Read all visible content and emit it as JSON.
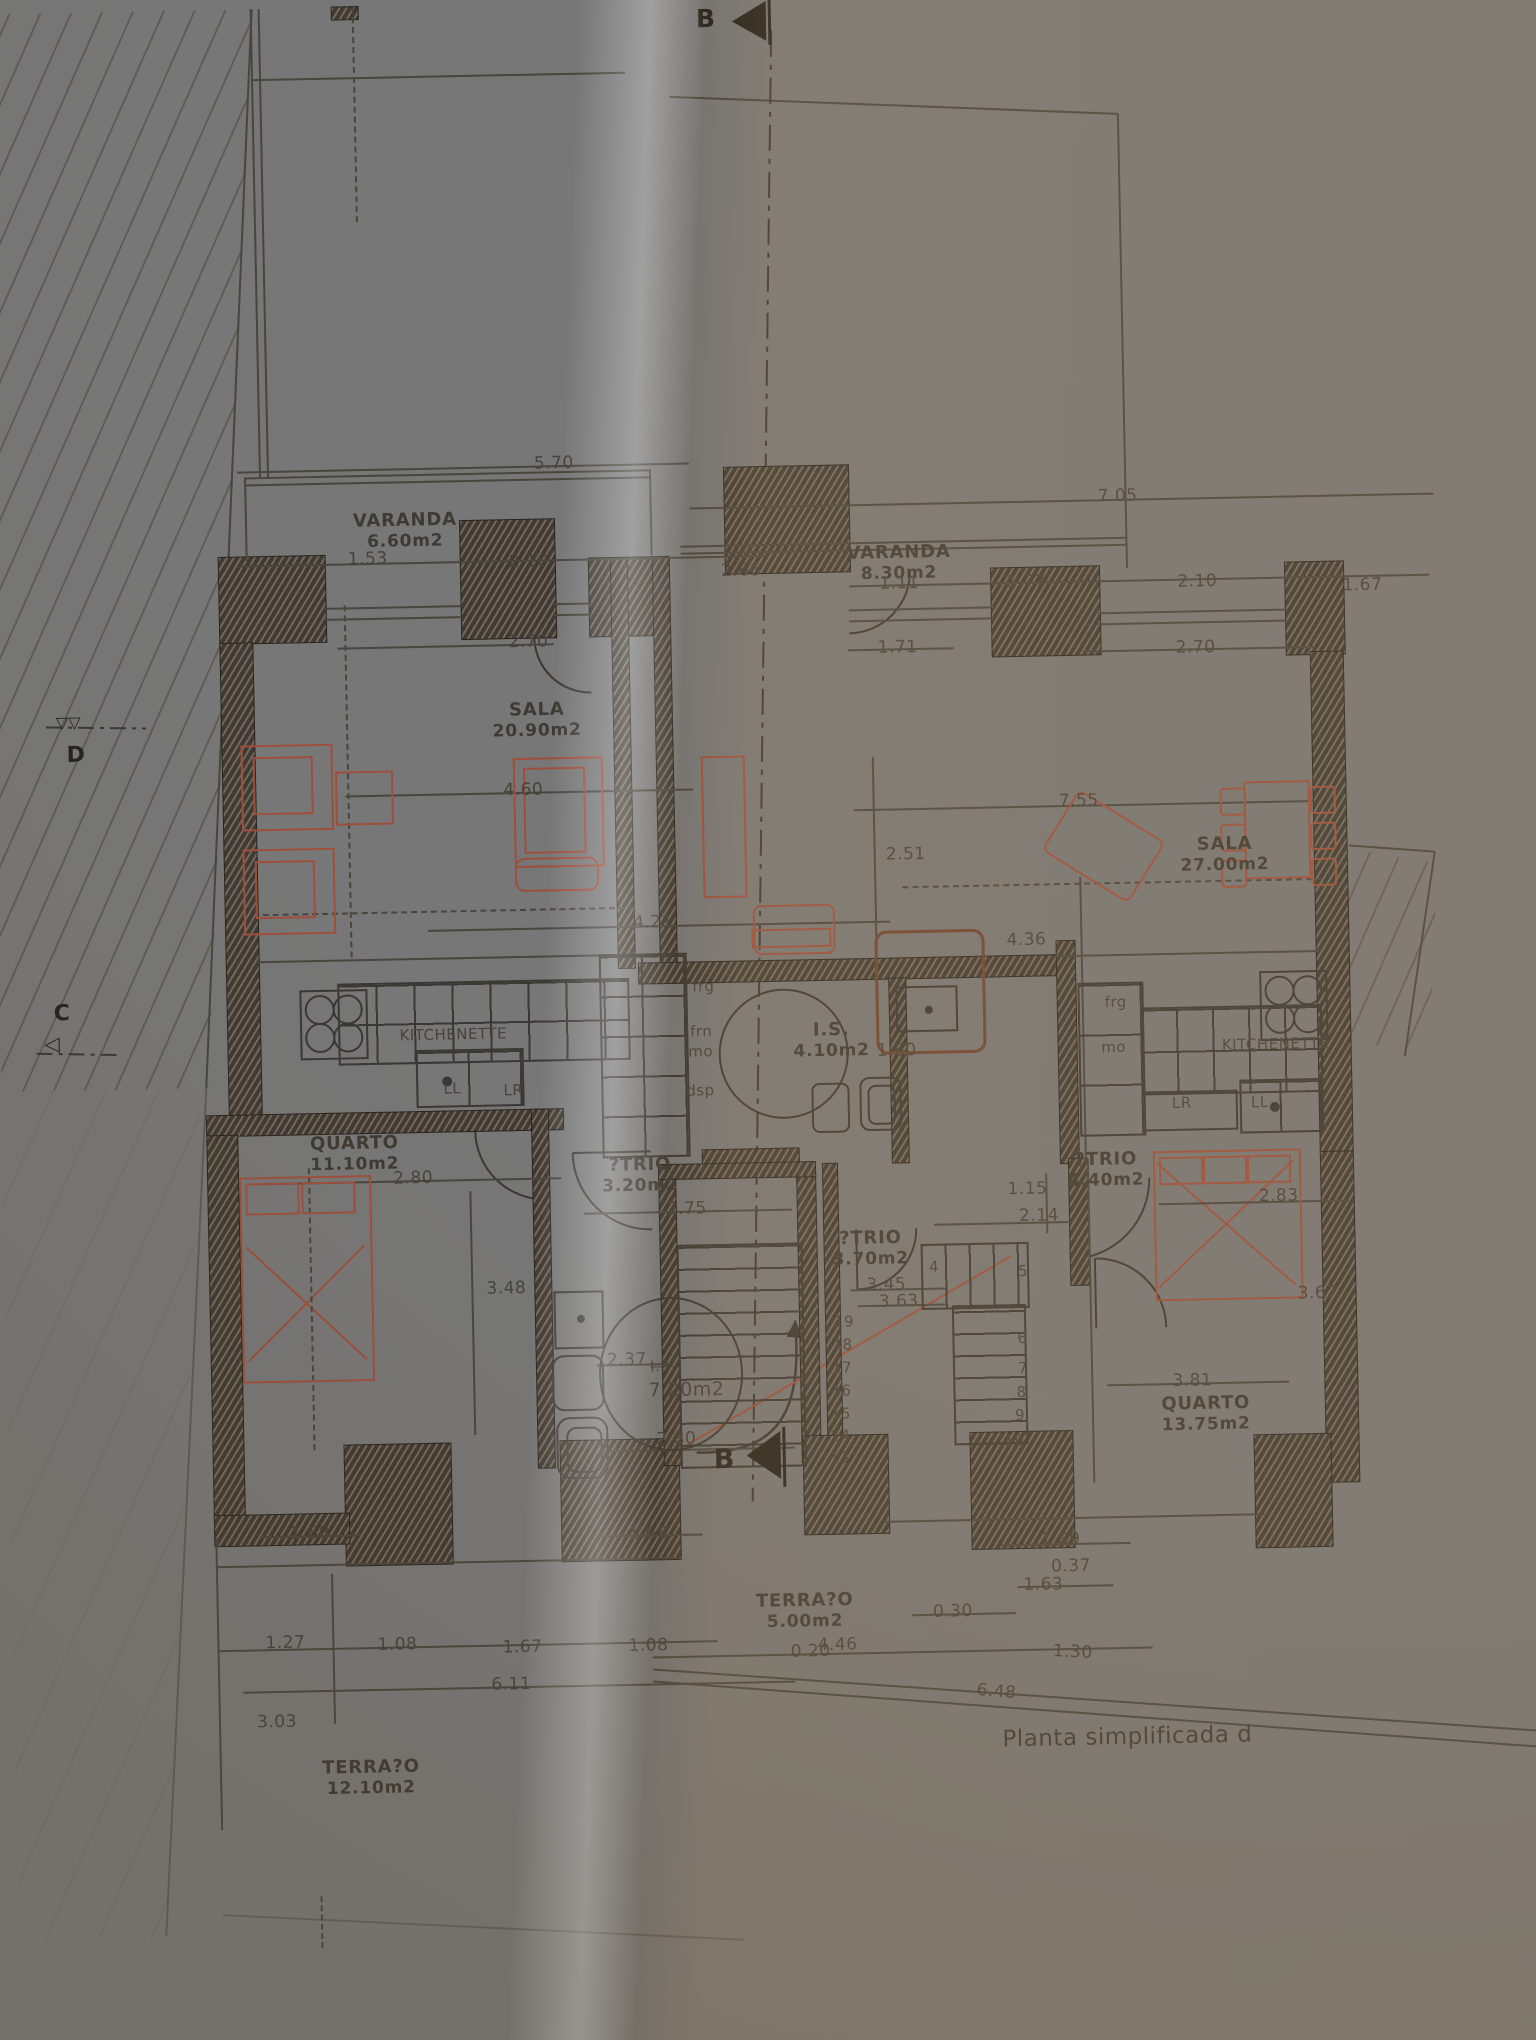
{
  "caption": "Planta simplificada d",
  "markers": {
    "section_top": "B",
    "section_bottom": "B",
    "section_d": "D",
    "section_c": "C"
  },
  "colors": {
    "ink": "#47423a",
    "wall": "#403a33",
    "furniture_accent": "#9e4f3c",
    "paper_left": "#e5e3df",
    "paper_right": "#d5c1a2"
  },
  "rooms": [
    {
      "name": "VARANDA",
      "area": "6.60m2",
      "x": 415,
      "y": 514
    },
    {
      "name": "VARANDA",
      "area": "8.30m2",
      "x": 908,
      "y": 556
    },
    {
      "name": "SALA",
      "area": "20.90m2",
      "x": 543,
      "y": 706
    },
    {
      "name": "SALA",
      "area": "27.00m2",
      "x": 1228,
      "y": 854
    },
    {
      "name": "QUARTO",
      "area": "11.10m2",
      "x": 352,
      "y": 1136
    },
    {
      "name": "QUARTO",
      "area": "13.75m2",
      "x": 1198,
      "y": 1413
    },
    {
      "name": "?TRIO",
      "area": "3.20m2",
      "x": 637,
      "y": 1163
    },
    {
      "name": "?TRIO",
      "area": "3.70m2",
      "x": 866,
      "y": 1241
    },
    {
      "name": "?TRIO",
      "area": "4.40m2",
      "x": 1103,
      "y": 1167
    },
    {
      "name": "I.S.",
      "area": "4.10m2",
      "x": 831,
      "y": 1032
    },
    {
      "name": "TERRA?O",
      "area": "5.00m2",
      "x": 793,
      "y": 1602
    },
    {
      "name": "TERRA?O",
      "area": "12.10m2",
      "x": 356,
      "y": 1760
    }
  ],
  "dims": [
    {
      "t": "5.70",
      "x": 565,
      "y": 460
    },
    {
      "t": "1.53",
      "x": 377,
      "y": 552
    },
    {
      "t": "2.10",
      "x": 538,
      "y": 558
    },
    {
      "t": "2.66",
      "x": 750,
      "y": 571
    },
    {
      "t": "2.70",
      "x": 536,
      "y": 638
    },
    {
      "t": "4.60",
      "x": 528,
      "y": 786
    },
    {
      "t": "4.21",
      "x": 655,
      "y": 921
    },
    {
      "t": "7.05",
      "x": 1128,
      "y": 504
    },
    {
      "t": "1.11",
      "x": 908,
      "y": 587
    },
    {
      "t": "1.77",
      "x": 1035,
      "y": 588
    },
    {
      "t": "2.10",
      "x": 1206,
      "y": 591
    },
    {
      "t": "1.67",
      "x": 1371,
      "y": 598
    },
    {
      "t": "1.71",
      "x": 905,
      "y": 651
    },
    {
      "t": "2.70",
      "x": 1203,
      "y": 657
    },
    {
      "t": "7.55",
      "x": 1083,
      "y": 808
    },
    {
      "t": "2.51",
      "x": 909,
      "y": 858
    },
    {
      "t": "4.36",
      "x": 1028,
      "y": 946
    },
    {
      "t": "1.60",
      "x": 896,
      "y": 1054
    },
    {
      "t": "2.80",
      "x": 410,
      "y": 1172
    },
    {
      "t": "2.75",
      "x": 683,
      "y": 1208
    },
    {
      "t": "1.15",
      "x": 1024,
      "y": 1195
    },
    {
      "t": "2.14",
      "x": 1035,
      "y": 1222
    },
    {
      "t": "2.83",
      "x": 1275,
      "y": 1207
    },
    {
      "t": "3.45",
      "x": 881,
      "y": 1288
    },
    {
      "t": "3.63",
      "x": 893,
      "y": 1305
    },
    {
      "t": "3.48",
      "x": 501,
      "y": 1284
    },
    {
      "t": "2.37",
      "x": 620,
      "y": 1358
    },
    {
      "t": "2.80",
      "x": 668,
      "y": 1438
    },
    {
      "t": "3.67",
      "x": 1312,
      "y": 1305
    },
    {
      "t": "3.81",
      "x": 1185,
      "y": 1390
    },
    {
      "t": "1.89",
      "x": 1050,
      "y": 1546
    },
    {
      "t": "1.68",
      "x": 300,
      "y": 1525
    },
    {
      "t": "1.68",
      "x": 638,
      "y": 1532
    },
    {
      "t": "0.30",
      "x": 941,
      "y": 1616
    },
    {
      "t": "0.37",
      "x": 1060,
      "y": 1573
    },
    {
      "t": "1.63",
      "x": 1032,
      "y": 1591
    },
    {
      "t": "4.46",
      "x": 825,
      "y": 1647
    },
    {
      "t": "0.20",
      "x": 798,
      "y": 1653
    },
    {
      "t": "1.30",
      "x": 1060,
      "y": 1659,
      "r": 4
    },
    {
      "t": "6.48",
      "x": 983,
      "y": 1697,
      "r": 6
    },
    {
      "t": "1.27",
      "x": 273,
      "y": 1634
    },
    {
      "t": "1.08",
      "x": 385,
      "y": 1638
    },
    {
      "t": "1.67",
      "x": 510,
      "y": 1643
    },
    {
      "t": "1.08",
      "x": 636,
      "y": 1644
    },
    {
      "t": "6.11",
      "x": 498,
      "y": 1680
    },
    {
      "t": "3.03",
      "x": 263,
      "y": 1713
    }
  ],
  "fixtures": [
    {
      "t": "KITCHENETTE",
      "x": 453,
      "y": 1029
    },
    {
      "t": "frg",
      "x": 704,
      "y": 986
    },
    {
      "t": "frn",
      "x": 701,
      "y": 1031
    },
    {
      "t": "mo",
      "x": 700,
      "y": 1051
    },
    {
      "t": "dsp",
      "x": 699,
      "y": 1090
    },
    {
      "t": "LL",
      "x": 451,
      "y": 1083
    },
    {
      "t": "LR",
      "x": 512,
      "y": 1086
    },
    {
      "t": "frg",
      "x": 1116,
      "y": 1010
    },
    {
      "t": "mo",
      "x": 1113,
      "y": 1055
    },
    {
      "t": "KITCHENETTE",
      "x": 1275,
      "y": 1055
    },
    {
      "t": "LR",
      "x": 1180,
      "y": 1112
    },
    {
      "t": "LL",
      "x": 1258,
      "y": 1113
    },
    {
      "t": "I.S.",
      "x": 656,
      "y": 1365,
      "strike": true
    },
    {
      "t": "7.20m2",
      "x": 679,
      "y": 1389,
      "fs": 19
    }
  ],
  "stairs": [
    {
      "t": "19",
      "x": 838,
      "y": 1324
    },
    {
      "t": "18",
      "x": 836,
      "y": 1347
    },
    {
      "t": "17",
      "x": 835,
      "y": 1370
    },
    {
      "t": "16",
      "x": 834,
      "y": 1393
    },
    {
      "t": "15",
      "x": 833,
      "y": 1416
    },
    {
      "t": "14",
      "x": 832,
      "y": 1438
    },
    {
      "t": "13",
      "x": 831,
      "y": 1460
    },
    {
      "t": "4",
      "x": 929,
      "y": 1271
    },
    {
      "t": "5",
      "x": 1018,
      "y": 1277
    },
    {
      "t": "6",
      "x": 1016,
      "y": 1344
    },
    {
      "t": "7",
      "x": 1016,
      "y": 1374
    },
    {
      "t": "8",
      "x": 1014,
      "y": 1398
    },
    {
      "t": "9",
      "x": 1012,
      "y": 1421
    },
    {
      "t": "10",
      "x": 1006,
      "y": 1446
    }
  ]
}
